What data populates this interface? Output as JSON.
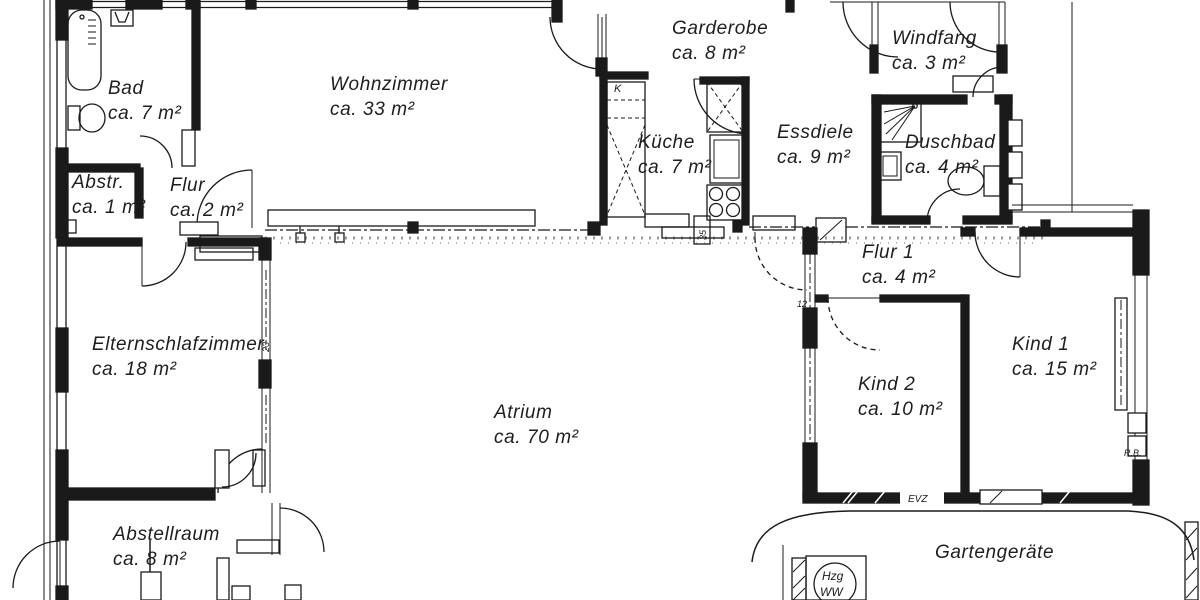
{
  "colors": {
    "ink": "#1a1a1a",
    "paper": "#ffffff"
  },
  "rooms": [
    {
      "id": "bad",
      "name": "Bad",
      "area": "ca. 7 m²"
    },
    {
      "id": "abstr",
      "name": "Abstr.",
      "area": "ca. 1 m²"
    },
    {
      "id": "flur",
      "name": "Flur",
      "area": "ca. 2 m²"
    },
    {
      "id": "wohnzimmer",
      "name": "Wohnzimmer",
      "area": "ca. 33 m²"
    },
    {
      "id": "garderobe",
      "name": "Garderobe",
      "area": "ca. 8 m²"
    },
    {
      "id": "windfang",
      "name": "Windfang",
      "area": "ca. 3 m²"
    },
    {
      "id": "kueche",
      "name": "Küche",
      "area": "ca. 7 m²"
    },
    {
      "id": "essdiele",
      "name": "Essdiele",
      "area": "ca. 9 m²"
    },
    {
      "id": "duschbad",
      "name": "Duschbad",
      "area": "ca. 4 m²"
    },
    {
      "id": "flur1",
      "name": "Flur 1",
      "area": "ca. 4 m²"
    },
    {
      "id": "eltern",
      "name": "Elternschlafzimmer",
      "area": "ca. 18 m²"
    },
    {
      "id": "kind2",
      "name": "Kind 2",
      "area": "ca. 10 m²"
    },
    {
      "id": "kind1",
      "name": "Kind 1",
      "area": "ca. 15 m²"
    },
    {
      "id": "atrium",
      "name": "Atrium",
      "area": "ca. 70 m²"
    },
    {
      "id": "abstellraum",
      "name": "Abstellraum",
      "area": "ca. 8 m²"
    },
    {
      "id": "gartengeraete",
      "name": "Gartengeräte"
    }
  ],
  "annotations": {
    "kitchen_cabinet": "K",
    "kitchen_dim": "35",
    "flur1_dim": "12",
    "eltern_dim": "23",
    "evz": "EVZ",
    "rb": "R.B.",
    "heater_top": "Hzg",
    "heater_bottom": "WW"
  }
}
